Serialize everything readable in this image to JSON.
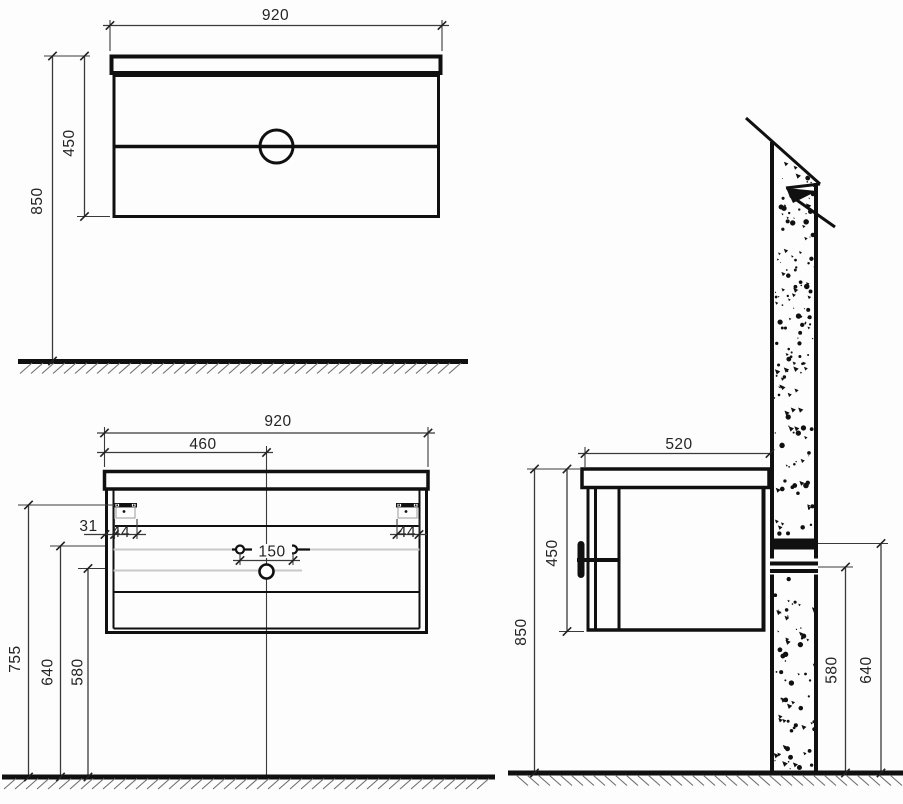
{
  "style": {
    "ink": "#101010",
    "hidden_line": "#c9c9c9",
    "background": "#fdfdfd"
  },
  "views": {
    "front_elevation": {
      "width_label": "920",
      "cabinet_height_label": "450",
      "top_height_label": "850"
    },
    "front_mounting": {
      "width_label": "920",
      "center_offset_label": "460",
      "bracket_inset_label": "31",
      "bracket_left_label": "44",
      "bracket_right_label": "44",
      "hole_spacing_label": "150",
      "bracket_height_label": "755",
      "fixing_height_label": "640",
      "drain_height_label": "580"
    },
    "side_section": {
      "depth_label": "520",
      "cabinet_height_label": "450",
      "top_height_label": "850",
      "lower_fixing_height_label": "580",
      "rail_height_label": "640"
    }
  }
}
